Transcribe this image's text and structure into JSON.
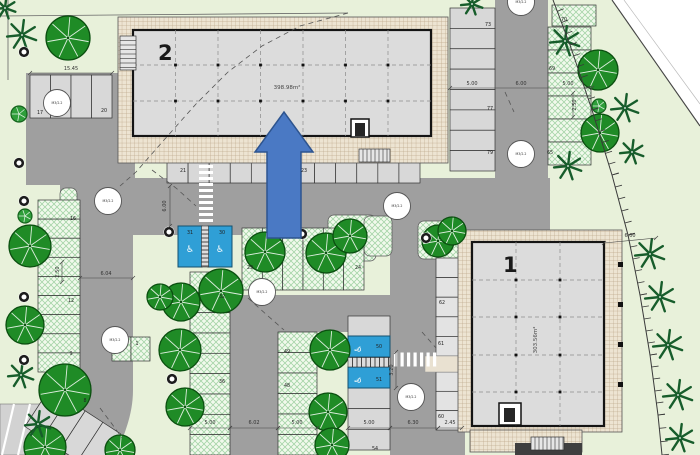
{
  "drawing_type": "site plan",
  "buildings": {
    "b2": {
      "number": "2",
      "area": "398.98m²"
    },
    "b1": {
      "number": "1",
      "area": "303.56m²"
    }
  },
  "colors": {
    "site_green": "#e8f1da",
    "road_gray": "#9f9f9f",
    "space_gray": "#d8d8d8",
    "space_gray_light": "#e3e3e3",
    "hatch_green_line": "#5aaf64",
    "apron_tan": "#ede4d2",
    "building_gray": "#dcdcdc",
    "outline": "#1a1a1a",
    "arrow_blue": "#4a79c4",
    "arrow_border": "#2d548f",
    "accessible_blue": "#2f9fd6",
    "tree_green": "#1f8b26",
    "palm_green": "#175d2b",
    "walk_beige": "#e9e1d1",
    "wall_dark": "#3f3f3f"
  },
  "parking_numbers": [
    [
      "17",
      40,
      114
    ],
    [
      "20",
      104,
      112
    ],
    [
      "16",
      73,
      220
    ],
    [
      "12",
      71,
      302
    ],
    [
      "9",
      71,
      355
    ],
    [
      "8",
      85,
      402
    ],
    [
      "1",
      137,
      345
    ],
    [
      "21",
      183,
      172
    ],
    [
      "23",
      304,
      172
    ],
    [
      "31",
      190,
      234
    ],
    [
      "30",
      222,
      234
    ],
    [
      "29",
      250,
      269
    ],
    [
      "24",
      358,
      269
    ],
    [
      "32",
      222,
      298
    ],
    [
      "36",
      222,
      383
    ],
    [
      "49",
      287,
      353
    ],
    [
      "48",
      287,
      387
    ],
    [
      "50",
      379,
      348
    ],
    [
      "51",
      379,
      381
    ],
    [
      "54",
      375,
      450
    ],
    [
      "62",
      442,
      304
    ],
    [
      "61",
      441,
      345
    ],
    [
      "60",
      441,
      418
    ],
    [
      "73",
      488,
      26
    ],
    [
      "77",
      490,
      110
    ],
    [
      "79",
      490,
      154
    ],
    [
      "70",
      564,
      21
    ],
    [
      "69",
      552,
      70
    ],
    [
      "65",
      550,
      154
    ]
  ],
  "dimensions": [
    {
      "t": "15.45",
      "x": 71,
      "y": 70,
      "r": 0
    },
    {
      "t": "5.00",
      "x": 472,
      "y": 85,
      "r": 0
    },
    {
      "t": "6.00",
      "x": 521,
      "y": 85,
      "r": 0
    },
    {
      "t": "5.00",
      "x": 568,
      "y": 85,
      "r": 0
    },
    {
      "t": "2.50",
      "x": 576,
      "y": 105,
      "r": -90
    },
    {
      "t": "6.04",
      "x": 106,
      "y": 275,
      "r": 0
    },
    {
      "t": "2.50",
      "x": 59,
      "y": 272,
      "r": -90
    },
    {
      "t": "6.00",
      "x": 166,
      "y": 206,
      "r": -90
    },
    {
      "t": "5.00",
      "x": 210,
      "y": 424,
      "r": 0
    },
    {
      "t": "6.02",
      "x": 254,
      "y": 424,
      "r": 0
    },
    {
      "t": "5.00",
      "x": 297,
      "y": 424,
      "r": 0
    },
    {
      "t": "5.00",
      "x": 369,
      "y": 424,
      "r": 0
    },
    {
      "t": "6.30",
      "x": 413,
      "y": 424,
      "r": 0
    },
    {
      "t": "2.45",
      "x": 450,
      "y": 424,
      "r": 0
    },
    {
      "t": "3.20",
      "x": 393,
      "y": 370,
      "r": -90
    },
    {
      "t": "6.00",
      "x": 630,
      "y": 237,
      "r": 0
    }
  ],
  "dim_lines": [
    [
      30,
      73,
      112,
      73
    ],
    [
      450,
      88,
      592,
      88
    ],
    [
      80,
      278,
      133,
      278
    ],
    [
      170,
      186,
      170,
      226
    ],
    [
      190,
      428,
      230,
      428
    ],
    [
      230,
      428,
      278,
      428
    ],
    [
      278,
      428,
      317,
      428
    ],
    [
      348,
      428,
      390,
      428
    ],
    [
      390,
      428,
      438,
      428
    ],
    [
      438,
      428,
      462,
      428
    ],
    [
      396,
      352,
      396,
      388
    ],
    [
      573,
      93,
      573,
      117
    ],
    [
      62,
      262,
      62,
      282
    ],
    [
      604,
      243,
      656,
      238
    ]
  ],
  "utility_labels": [
    {
      "x": 57,
      "y": 103,
      "t": "M3/2.2"
    },
    {
      "x": 108,
      "y": 201,
      "t": "M3/2.2"
    },
    {
      "x": 115,
      "y": 340,
      "t": "M3/2.2"
    },
    {
      "x": 262,
      "y": 292,
      "t": "M3/2.2"
    },
    {
      "x": 397,
      "y": 206,
      "t": "M3/2.2"
    },
    {
      "x": 411,
      "y": 397,
      "t": "M3/2.2"
    },
    {
      "x": 521,
      "y": 154,
      "t": "M3/2.2"
    },
    {
      "x": 521,
      "y": 2,
      "t": "M3/2.2"
    }
  ],
  "plan": {
    "roads": [
      [
        26,
        73,
        109,
        112
      ],
      [
        60,
        178,
        490,
        57
      ],
      [
        495,
        0,
        53,
        235
      ],
      [
        390,
        228,
        48,
        227
      ],
      [
        230,
        295,
        208,
        37
      ],
      [
        230,
        295,
        48,
        160
      ],
      [
        80,
        178,
        53,
        202
      ],
      [
        438,
        430,
        27,
        25
      ]
    ],
    "road_paths": [
      "M78,378 L133,378 L133,390 C133,415 124,435 116,455 L40,455 C57,430 70,405 74,386 Z"
    ],
    "corner_block": {
      "rect": [
        0,
        404,
        56,
        51
      ],
      "stripes": [
        [
          14,
          404,
          2,
          455
        ],
        [
          30,
          404,
          18,
          455
        ],
        [
          46,
          404,
          34,
          455
        ]
      ]
    },
    "islands": [
      [
        328,
        215,
        48,
        46
      ],
      [
        418,
        221,
        44,
        38
      ],
      [
        60,
        188,
        17,
        36
      ],
      [
        364,
        216,
        28,
        40
      ]
    ],
    "rows": [
      {
        "x": 30,
        "y": 75,
        "w": 82,
        "h": 43,
        "n": 4,
        "ax": "x",
        "k": "g"
      },
      {
        "x": 167,
        "y": 160,
        "w": 253,
        "h": 23,
        "n": 12,
        "ax": "x",
        "k": "g"
      },
      {
        "x": 450,
        "y": 8,
        "w": 45,
        "h": 163,
        "n": 8,
        "ax": "y",
        "k": "g"
      },
      {
        "x": 548,
        "y": 27,
        "w": 43,
        "h": 138,
        "n": 6,
        "ax": "y",
        "k": "gr"
      },
      {
        "x": 552,
        "y": 5,
        "w": 44,
        "h": 21,
        "n": 1,
        "ax": "x",
        "k": "gr"
      },
      {
        "x": 38,
        "y": 200,
        "w": 42,
        "h": 172,
        "n": 9,
        "ax": "y",
        "k": "gr"
      },
      {
        "x": 242,
        "y": 228,
        "w": 122,
        "h": 62,
        "n": 6,
        "ax": "x",
        "k": "gr"
      },
      {
        "x": 190,
        "y": 272,
        "w": 40,
        "h": 183,
        "n": 9,
        "ax": "y",
        "k": "gr"
      },
      {
        "x": 278,
        "y": 332,
        "w": 39,
        "h": 123,
        "n": 6,
        "ax": "y",
        "k": "gr"
      },
      {
        "x": 348,
        "y": 316,
        "w": 42,
        "h": 21,
        "n": 1,
        "ax": "x",
        "k": "g"
      },
      {
        "x": 348,
        "y": 388,
        "w": 42,
        "h": 62,
        "n": 3,
        "ax": "y",
        "k": "g"
      },
      {
        "x": 436,
        "y": 258,
        "w": 24,
        "h": 98,
        "n": 5,
        "ax": "y",
        "k": "g2"
      },
      {
        "x": 436,
        "y": 372,
        "w": 24,
        "h": 58,
        "n": 3,
        "ax": "y",
        "k": "g2"
      },
      {
        "x": 112,
        "y": 337,
        "w": 38,
        "h": 24,
        "n": 2,
        "ax": "x",
        "k": "gr"
      }
    ],
    "angled": {
      "x": 50,
      "y": 388,
      "sw": 21,
      "sh": 46,
      "n": 4,
      "rot": 33
    },
    "blue_spaces": [
      [
        178,
        226,
        24,
        41
      ],
      [
        208,
        226,
        24,
        41
      ],
      [
        348,
        336,
        42,
        21
      ],
      [
        348,
        367,
        42,
        21
      ]
    ],
    "wheelchairs": [
      {
        "x": 190,
        "y": 252,
        "r": 0
      },
      {
        "x": 220,
        "y": 252,
        "r": 0
      },
      {
        "x": 361,
        "y": 349,
        "r": -90
      },
      {
        "x": 361,
        "y": 380,
        "r": -90
      }
    ],
    "walkways": [
      [
        425,
        356,
        35,
        16
      ]
    ],
    "crosswalks": [
      {
        "x": 198,
        "y": 163,
        "w": 16,
        "h": 61,
        "o": "h"
      },
      {
        "x": 392,
        "y": 351,
        "w": 47,
        "h": 17,
        "o": "v"
      }
    ],
    "ladders": [
      {
        "x": 201.5,
        "y": 226,
        "w": 7,
        "h": 41,
        "o": "h",
        "s": 4
      },
      {
        "x": 348,
        "y": 357.5,
        "w": 42,
        "h": 9.5,
        "o": "v",
        "s": 4.5
      }
    ],
    "steps": [
      {
        "x": 120,
        "y": 36,
        "w": 16,
        "h": 34,
        "o": "h",
        "s": 4.5
      },
      {
        "x": 359,
        "y": 149,
        "w": 31,
        "h": 13,
        "o": "v",
        "s": 4
      },
      {
        "x": 531,
        "y": 437,
        "w": 33,
        "h": 13,
        "o": "v",
        "s": 4
      }
    ],
    "aprons": {
      "b2": [
        118,
        17,
        330,
        146
      ],
      "b1": [
        458,
        230,
        164,
        202
      ],
      "b1ext": [
        470,
        430,
        112,
        22
      ]
    },
    "bldg_rects": {
      "b2": [
        133,
        30,
        298,
        106
      ],
      "b1": [
        472,
        242,
        132,
        184
      ]
    },
    "b2grid": {
      "vx": [
        175.5,
        218,
        260.5,
        303,
        345.5,
        388
      ],
      "hy": [
        65,
        101
      ],
      "x1": 133,
      "x2": 431,
      "y1": 30,
      "y2": 136
    },
    "b1grid": {
      "vx": [
        516,
        560
      ],
      "hy": [
        280,
        317,
        355,
        392
      ],
      "x1": 472,
      "x2": 604,
      "y1": 242,
      "y2": 426
    },
    "stair_blocks": [
      {
        "o": [
          351,
          119,
          18,
          18
        ],
        "i": [
          355,
          123,
          10,
          13
        ]
      },
      {
        "o": [
          499,
          403,
          22,
          22
        ],
        "i": [
          504,
          408,
          11,
          14
        ]
      }
    ],
    "edge_ticks": [
      [
        618,
        262
      ],
      [
        618,
        302
      ],
      [
        618,
        342
      ],
      [
        618,
        382
      ]
    ],
    "wall_bar": [
      515,
      443,
      67,
      12
    ],
    "arrow": [
      [
        267,
        238
      ],
      [
        267,
        152
      ],
      [
        255,
        152
      ],
      [
        284,
        112
      ],
      [
        313,
        152
      ],
      [
        301,
        152
      ],
      [
        301,
        238
      ]
    ],
    "b2_label_pos": [
      158,
      60
    ],
    "b2_area_pos": [
      287,
      89
    ],
    "b1_label_pos": [
      503,
      272
    ],
    "b1_area_pos": [
      537,
      340
    ],
    "trees_round": [
      [
        68,
        38,
        22
      ],
      [
        30,
        246,
        21
      ],
      [
        25,
        325,
        19
      ],
      [
        65,
        390,
        26
      ],
      [
        45,
        447,
        21
      ],
      [
        120,
        450,
        15
      ],
      [
        221,
        291,
        22
      ],
      [
        181,
        302,
        19
      ],
      [
        180,
        350,
        21
      ],
      [
        185,
        407,
        19
      ],
      [
        160,
        297,
        13
      ],
      [
        265,
        252,
        20
      ],
      [
        326,
        253,
        20
      ],
      [
        350,
        236,
        17
      ],
      [
        330,
        350,
        20
      ],
      [
        328,
        412,
        19
      ],
      [
        332,
        445,
        17
      ],
      [
        438,
        241,
        16
      ],
      [
        452,
        231,
        14
      ],
      [
        598,
        70,
        20
      ],
      [
        600,
        133,
        19
      ]
    ],
    "trees_palm": [
      [
        22,
        35,
        15
      ],
      [
        5,
        8,
        11
      ],
      [
        21,
        375,
        13
      ],
      [
        38,
        424,
        13
      ],
      [
        472,
        4,
        11
      ],
      [
        565,
        41,
        15
      ],
      [
        568,
        166,
        14
      ],
      [
        625,
        108,
        14
      ],
      [
        632,
        152,
        12
      ],
      [
        650,
        254,
        15
      ],
      [
        660,
        297,
        15
      ],
      [
        668,
        345,
        15
      ],
      [
        678,
        395,
        15
      ],
      [
        680,
        438,
        14
      ]
    ],
    "rings": [
      [
        24,
        52
      ],
      [
        19,
        163
      ],
      [
        24,
        201
      ],
      [
        24,
        297
      ],
      [
        24,
        360
      ],
      [
        169,
        232
      ],
      [
        172,
        379
      ],
      [
        302,
        234
      ],
      [
        426,
        238
      ]
    ],
    "bushes": [
      [
        19,
        114,
        8
      ],
      [
        25,
        216,
        7
      ],
      [
        599,
        106,
        7
      ]
    ],
    "fence": [
      [
        553,
        0
      ],
      [
        570,
        45
      ],
      [
        592,
        110
      ],
      [
        612,
        175
      ],
      [
        628,
        235
      ],
      [
        640,
        295
      ],
      [
        650,
        355
      ],
      [
        658,
        415
      ],
      [
        662,
        455
      ]
    ],
    "boundary_lines": [
      {
        "p": [
          0,
          16,
          348,
          13
        ],
        "c": "#666",
        "w": 0.8
      },
      {
        "p": [
          8,
          0,
          8,
          80
        ],
        "c": "#666",
        "w": 0.8
      },
      {
        "p": [
          612,
          0,
          700,
          126
        ],
        "c": "#444",
        "w": 1.1
      },
      {
        "p": [
          624,
          0,
          700,
          104
        ],
        "c": "#bbb",
        "w": 0.7
      }
    ],
    "white_area": "612,0 700,0 700,126",
    "dashes": [
      [
        [
          348,
          13
        ],
        [
          300,
          26
        ],
        [
          262,
          46
        ],
        [
          228,
          72
        ],
        [
          196,
          104
        ],
        [
          164,
          140
        ],
        [
          136,
          172
        ],
        [
          120,
          186
        ]
      ],
      [
        [
          152,
          170
        ],
        [
          176,
          188
        ],
        [
          196,
          206
        ]
      ],
      [
        [
          248,
          298
        ],
        [
          268,
          316
        ],
        [
          284,
          330
        ]
      ],
      [
        [
          100,
          408
        ],
        [
          112,
          424
        ],
        [
          122,
          438
        ]
      ],
      [
        [
          422,
          332
        ],
        [
          436,
          348
        ]
      ],
      [
        [
          505,
          92
        ],
        [
          514,
          112
        ]
      ]
    ]
  }
}
